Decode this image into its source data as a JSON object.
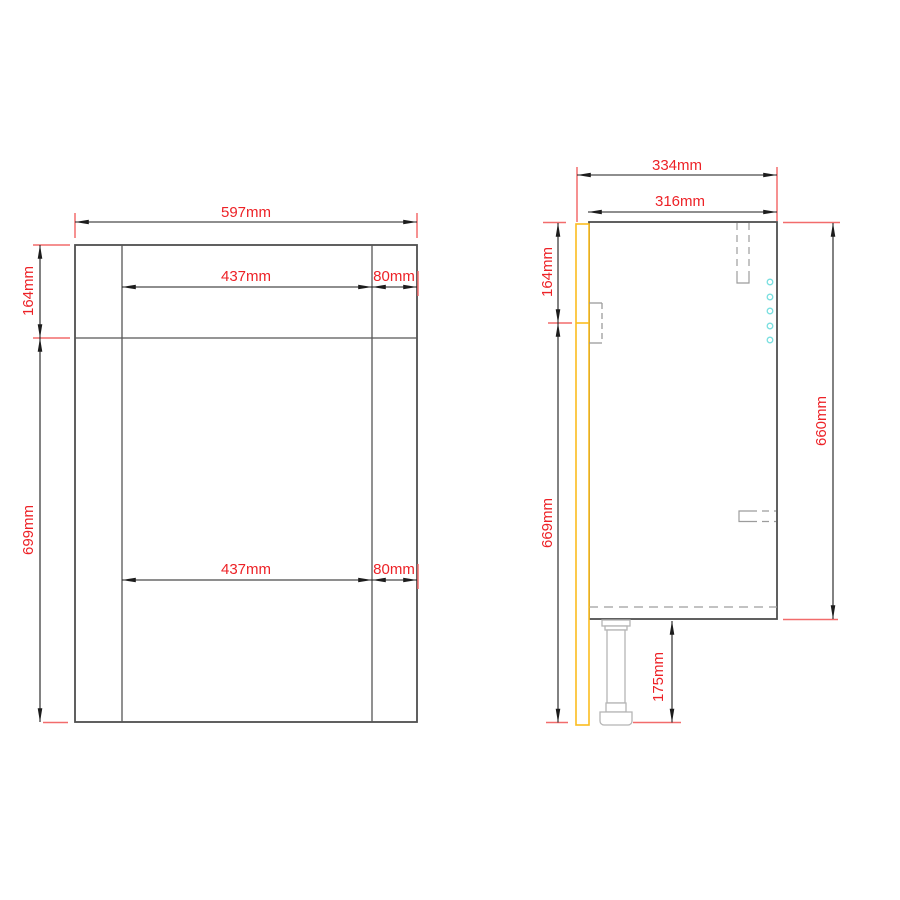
{
  "colors": {
    "cabinet_outline": "#4f4f4f",
    "dimension_lines": "#1c1c1c",
    "dimension_text": "#ed2227",
    "extension_ticks": "#f26c6c",
    "door_panel": "#fbbc1f",
    "shelf_pin_holes": "#7adfe0",
    "hidden_detail": "#9e9e9e",
    "leg_outline": "#b5b5b5",
    "background": "#ffffff"
  },
  "front_view": {
    "dim_overall_width": "597mm",
    "dim_top_section_height": "164mm",
    "dim_lower_section_height": "699mm",
    "dim_top_center_width": "437mm",
    "dim_top_right_width": "80mm",
    "dim_bottom_center_width": "437mm",
    "dim_bottom_right_width": "80mm"
  },
  "side_view": {
    "dim_overall_depth": "334mm",
    "dim_body_depth": "316mm",
    "dim_top_section_height": "164mm",
    "dim_front_height": "669mm",
    "dim_body_height": "660mm",
    "dim_leg_height": "175mm"
  }
}
